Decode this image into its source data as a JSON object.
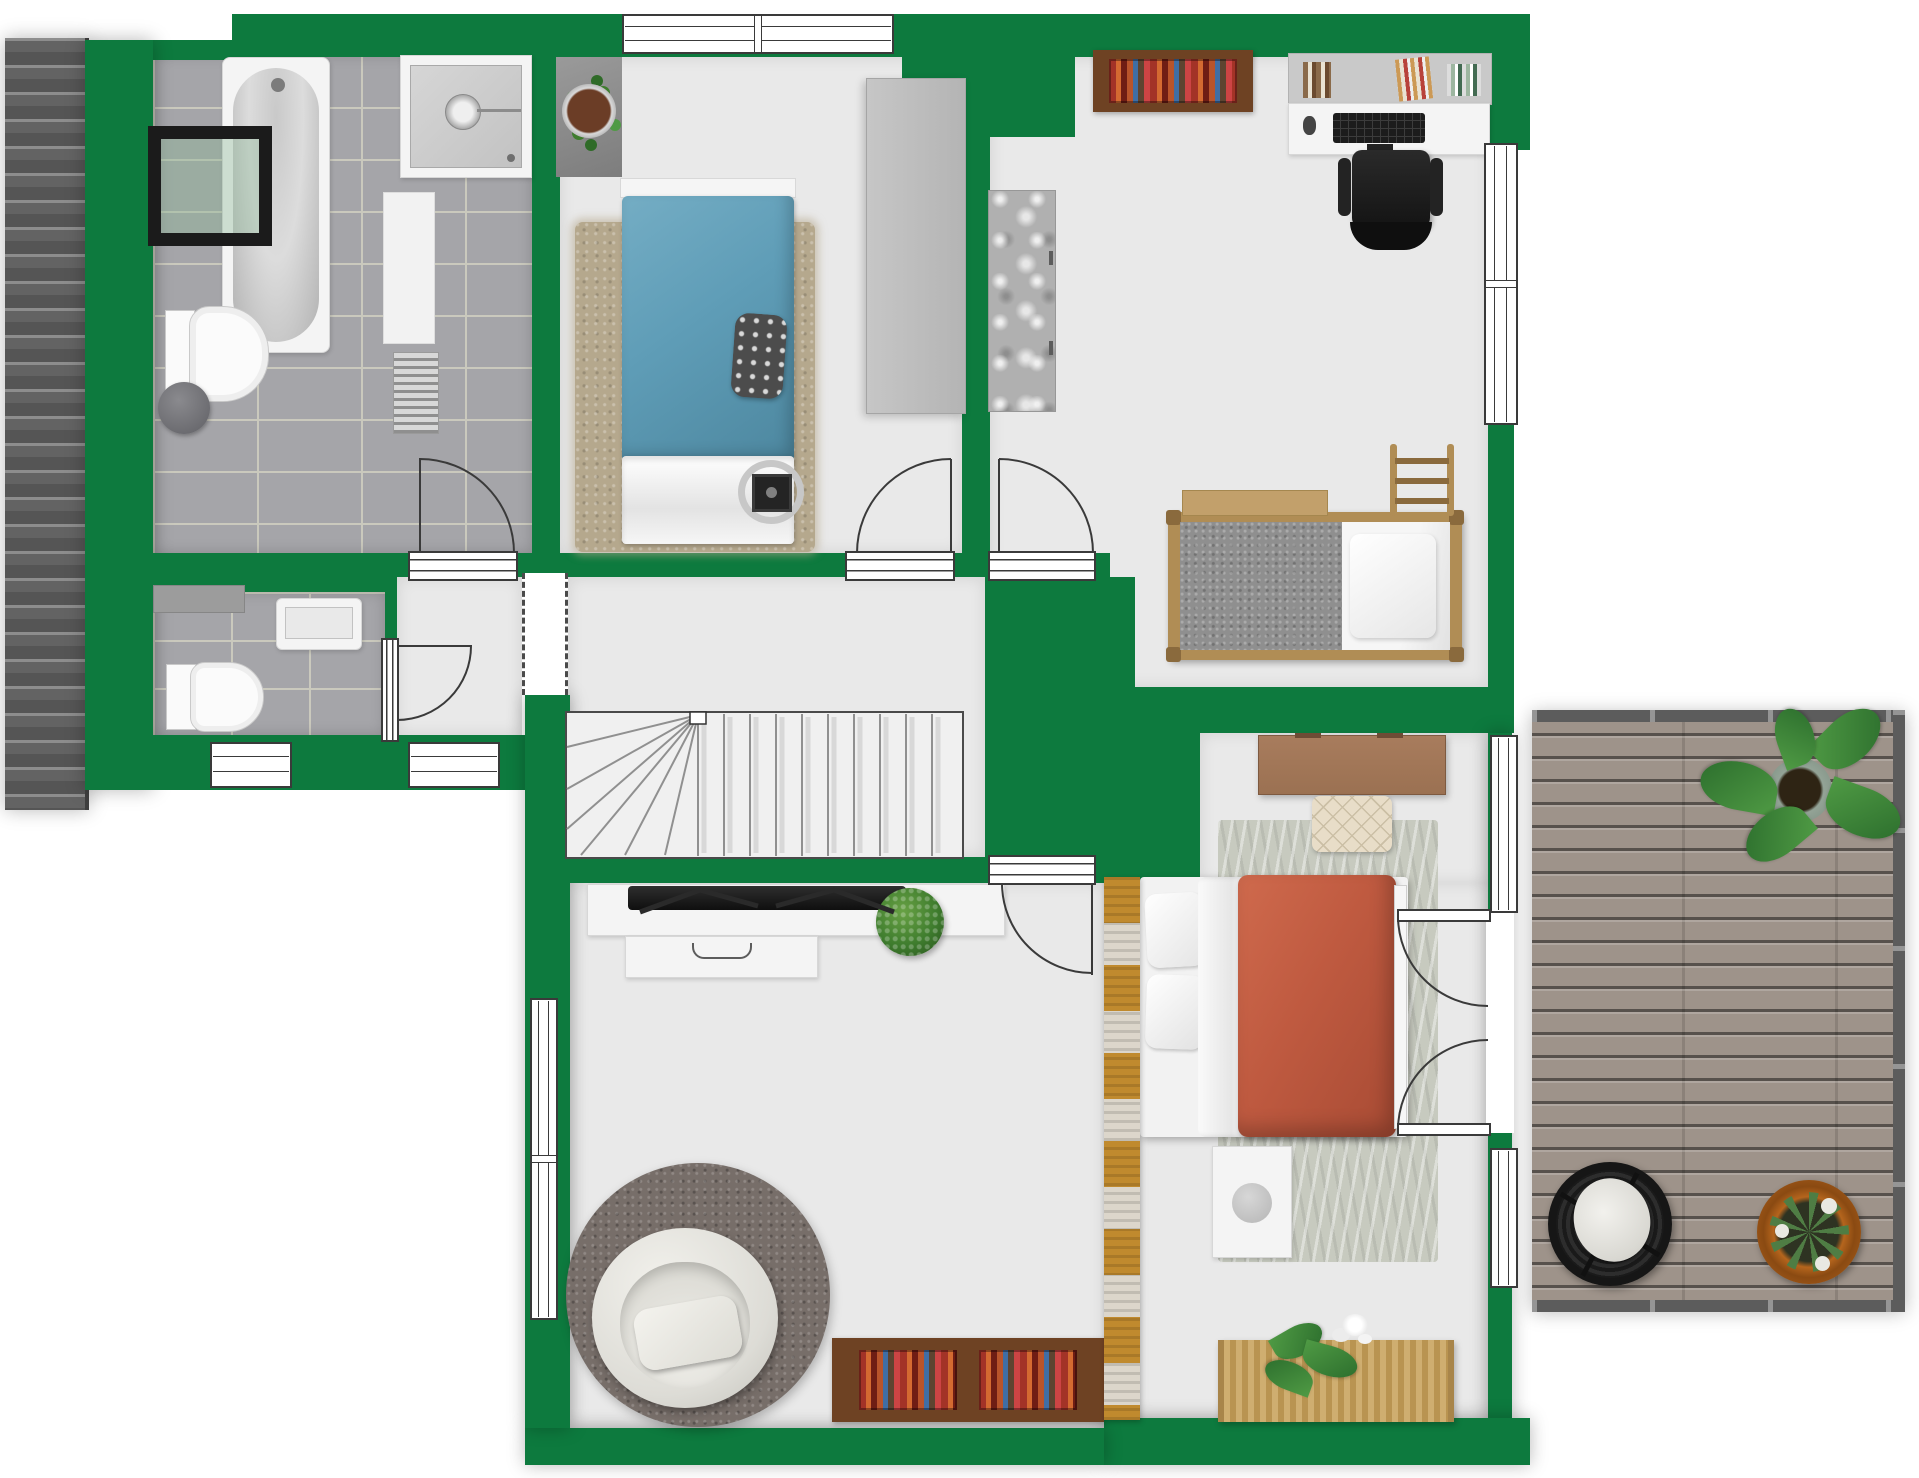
{
  "plan": {
    "view": "top-down floor plan",
    "floor": "attic level with roof deck"
  },
  "colors": {
    "wall": "#0d7a3e",
    "floor": "#e9e9e9",
    "tile": "#a5a5a9",
    "grout": "#cac9bd",
    "roof": "#6e6e6e",
    "deck": "#9e938a",
    "rail": "#5c5c5c",
    "line": "#3a3a3a",
    "rug_beige": "#b5a88d",
    "rug_gray": "#c7cabf",
    "rug_round": "#776e69",
    "bed_blue": "#5f9db7",
    "bed_red": "#bf5a40",
    "wood": "#b08d55",
    "wood_dark": "#8a6a3d",
    "brown": "#6e4223",
    "desk_brown": "#9b7152",
    "bench_cream": "#e8ddc8",
    "chair_black": "#1c1c1c",
    "plant": "#3f7d2e",
    "amber": "#c08a2e",
    "speckle": "#dcd6cb",
    "mattress_gray": "#8f8f8f",
    "wardrobe": "#bdbdbd",
    "marble": "#b0b0b0"
  },
  "rooms": {
    "bathroom": {
      "name": "bathroom",
      "floor": "gray tiles",
      "items": [
        "bathtub",
        "roof-window",
        "shower",
        "bath-mat",
        "towel-radiator",
        "toilet",
        "waste-bin"
      ]
    },
    "wc": {
      "name": "toilet-room",
      "floor": "gray tiles",
      "items": [
        "wall-shelf",
        "sink",
        "toilet",
        "window"
      ]
    },
    "hallway": {
      "name": "hallway",
      "items": [
        "door-to-wc",
        "window",
        "open-passage"
      ]
    },
    "stair_hall": {
      "name": "stair-hall",
      "items": [
        "winder-staircase"
      ]
    },
    "bedroom_blue": {
      "name": "bedroom-single",
      "items": [
        "potted-plant-on-mat",
        "area-rug",
        "single-bed-blue",
        "patterned-pillow",
        "wardrobe",
        "floor-speaker",
        "window"
      ]
    },
    "kids_room": {
      "name": "kids-room-study",
      "items": [
        "wall-bookshelf",
        "desk-shelf-with-books",
        "desk",
        "keyboard",
        "office-chair",
        "wardrobe",
        "loft-bed",
        "ladder",
        "window"
      ]
    },
    "living_room": {
      "name": "living-room",
      "items": [
        "tv-sideboard",
        "tv",
        "drawer-unit",
        "potted-plant",
        "round-rug",
        "armchair",
        "low-bookshelf",
        "window"
      ]
    },
    "master_bedroom": {
      "name": "master-bedroom",
      "items": [
        "desk",
        "upholstered-bench",
        "area-rug",
        "double-bed-red",
        "pillows",
        "white-sheet",
        "nightstand",
        "firewood-rack",
        "woven-chest-with-orchid",
        "window-upper",
        "french-doors",
        "window-lower"
      ]
    },
    "deck": {
      "name": "roof-terrace",
      "items": [
        "wood-decking",
        "railing",
        "large-leaf-plant",
        "rattan-hanging-chair",
        "potted-agave"
      ]
    }
  },
  "openings": {
    "windows_total": 7,
    "interior_doors": 5,
    "french_door_leaves": 2,
    "stair_treads": 15
  },
  "exterior": {
    "left_strip": "tiled roof slope",
    "background": "white"
  }
}
